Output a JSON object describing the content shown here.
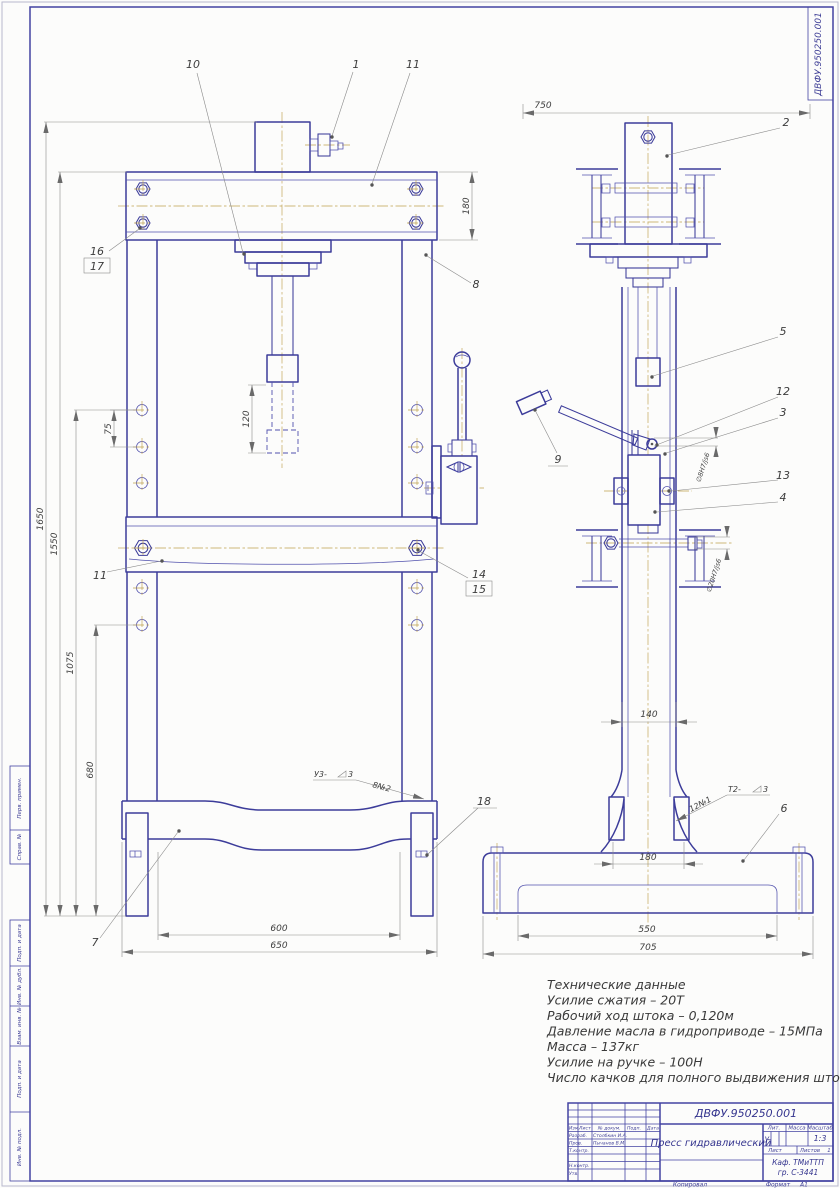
{
  "stamps": {
    "corner_number": "ДВФУ.950250.001",
    "left_margin": [
      "Перв. примен.",
      "Справ. №",
      "Подп. и дата",
      "Инв. № дубл.",
      "Взам. инв. №",
      "Подп. и дата",
      "Инв. № подл."
    ]
  },
  "callouts": [
    "1",
    "2",
    "3",
    "4",
    "5",
    "6",
    "7",
    "8",
    "9",
    "10",
    "11",
    "12",
    "13",
    "14",
    "15",
    "16",
    "17",
    "18",
    "11"
  ],
  "dimensions": {
    "front": {
      "beam_height": "180",
      "ram_stroke": "120",
      "hole_pitch": "75",
      "total_height": "1650",
      "frame_height": "1550",
      "mid_height": "1075",
      "lower_height": "680",
      "table_span": "600",
      "base_span": "650"
    },
    "side": {
      "overall_top": "750",
      "column_depth": "140",
      "pedestal_width": "180",
      "base_inner": "550",
      "base_overall": "705",
      "pin_fit": "∅8H7/js6",
      "bolt_fit": "∅20H7/js6"
    }
  },
  "welds": {
    "front": {
      "code": "У3-",
      "size": "3",
      "note": "8№2"
    },
    "side": {
      "code": "Т2-",
      "size": "3",
      "note": "12№1"
    }
  },
  "tech_data": {
    "title": "Технические данные",
    "lines": [
      "Усилие сжатия – 20Т",
      "Рабочий ход штока – 0,120м",
      "Давление масла в гидроприводе – 15МПа",
      "Масса – 137кг",
      "Усилие на ручке – 100Н",
      "Число качков для полного выдвижения штотка – 600"
    ]
  },
  "title_block": {
    "doc_number": "ДВФУ.950250.001",
    "title": "Пресс гидравлический",
    "cols": {
      "izm": "Изм.",
      "list": "Лист",
      "doc": "№ докум.",
      "sign": "Подп.",
      "date": "Дата"
    },
    "rows": {
      "developed": "Разраб.",
      "checked": "Пров.",
      "tcontrol": "Т.контр.",
      "ncontrol": "Н.контр.",
      "approved": "Утв."
    },
    "names": {
      "developed": "Столбкин И.А.",
      "checked": "Пычанов В.М."
    },
    "lit_label": "Лит.",
    "mass_label": "Масса",
    "scale_label": "Масштаб",
    "lit_value": "у",
    "scale_value": "1:3",
    "sheet_label": "Лист",
    "sheets_label": "Листов",
    "sheets_value": "1",
    "org1": "Каф. ТМиТТП",
    "org2": "гр. С-3441",
    "copied": "Копировал",
    "format_label": "Формат",
    "format_value": "А1"
  }
}
